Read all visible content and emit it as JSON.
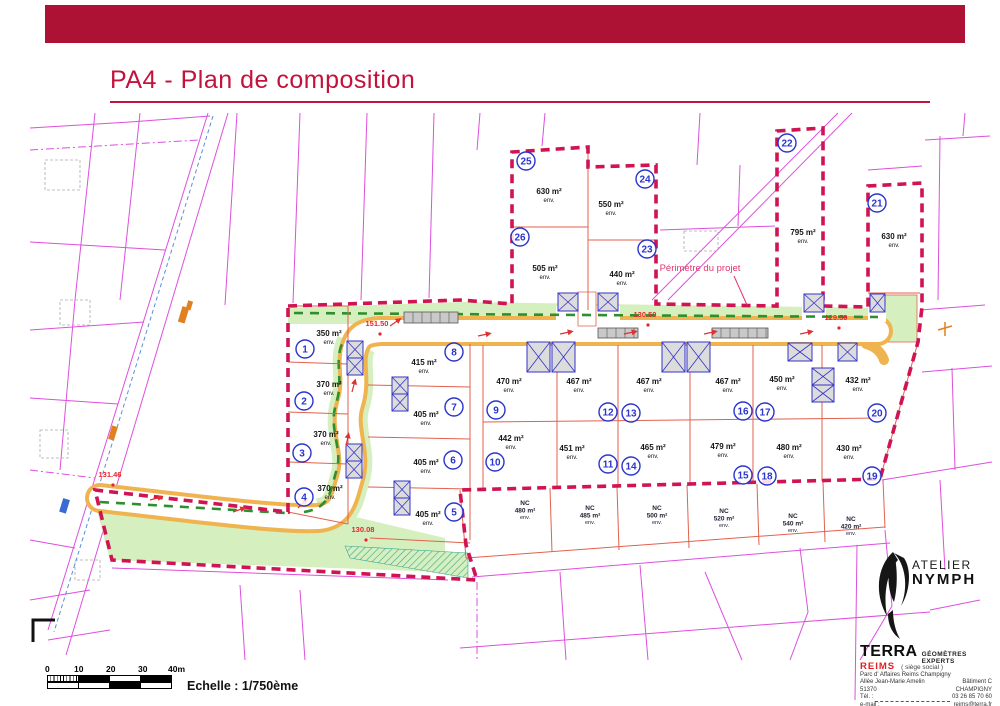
{
  "header": {
    "title": "PA4 - Plan de composition"
  },
  "colors": {
    "banner": "#ad1134",
    "title_red": "#c3123c",
    "perimeter_pink": "#d01353",
    "cadastral_magenta": "#dd4fdd",
    "lot_line_salmon": "#e2614e",
    "road_orange": "#efb44f",
    "green_strip": "#d6efbe",
    "hedge_green": "#2f8f2f",
    "building_blue": "#3535c8",
    "lot_number_blue": "#2a35cc",
    "elevation_red": "#e8242c"
  },
  "map": {
    "perimeter_label": "Périmètre du projet",
    "env_label": "env.",
    "lots": [
      {
        "n": "1",
        "area": "350 m²",
        "cx": 305,
        "cy": 349,
        "tx": 329,
        "ty": 336
      },
      {
        "n": "2",
        "area": "370 m²",
        "cx": 304,
        "cy": 401,
        "tx": 329,
        "ty": 387
      },
      {
        "n": "3",
        "area": "370 m²",
        "cx": 302,
        "cy": 453,
        "tx": 326,
        "ty": 437
      },
      {
        "n": "4",
        "area": "370 m²",
        "cx": 304,
        "cy": 497,
        "tx": 330,
        "ty": 491
      },
      {
        "n": "5",
        "area": "405 m²",
        "cx": 454,
        "cy": 512,
        "tx": 428,
        "ty": 517
      },
      {
        "n": "6",
        "area": "405 m²",
        "cx": 453,
        "cy": 460,
        "tx": 426,
        "ty": 465
      },
      {
        "n": "7",
        "area": "405 m²",
        "cx": 454,
        "cy": 407,
        "tx": 426,
        "ty": 417
      },
      {
        "n": "8",
        "area": "415 m²",
        "cx": 454,
        "cy": 352,
        "tx": 424,
        "ty": 365
      },
      {
        "n": "9",
        "area": "470 m²",
        "cx": 496,
        "cy": 410,
        "tx": 509,
        "ty": 384
      },
      {
        "n": "10",
        "area": "442 m²",
        "cx": 495,
        "cy": 462,
        "tx": 511,
        "ty": 441
      },
      {
        "n": "11",
        "area": "451 m²",
        "cx": 608,
        "cy": 464,
        "tx": 572,
        "ty": 451
      },
      {
        "n": "12",
        "area": "467 m²",
        "cx": 608,
        "cy": 412,
        "tx": 579,
        "ty": 384
      },
      {
        "n": "13",
        "area": "467 m²",
        "cx": 631,
        "cy": 413,
        "tx": 649,
        "ty": 384
      },
      {
        "n": "14",
        "area": "465 m²",
        "cx": 631,
        "cy": 466,
        "tx": 653,
        "ty": 450
      },
      {
        "n": "15",
        "area": "479 m²",
        "cx": 743,
        "cy": 475,
        "tx": 723,
        "ty": 449
      },
      {
        "n": "16",
        "area": "467 m²",
        "cx": 743,
        "cy": 411,
        "tx": 728,
        "ty": 384
      },
      {
        "n": "17",
        "area": "450 m²",
        "cx": 765,
        "cy": 412,
        "tx": 782,
        "ty": 382
      },
      {
        "n": "18",
        "area": "480 m²",
        "cx": 767,
        "cy": 476,
        "tx": 789,
        "ty": 450
      },
      {
        "n": "19",
        "area": "430 m²",
        "cx": 872,
        "cy": 476,
        "tx": 849,
        "ty": 451
      },
      {
        "n": "20",
        "area": "432 m²",
        "cx": 877,
        "cy": 413,
        "tx": 858,
        "ty": 383
      },
      {
        "n": "21",
        "area": "630 m²",
        "cx": 877,
        "cy": 203,
        "tx": 894,
        "ty": 239
      },
      {
        "n": "22",
        "area": "795 m²",
        "cx": 787,
        "cy": 143,
        "tx": 803,
        "ty": 235
      },
      {
        "n": "23",
        "area": "440 m²",
        "cx": 647,
        "cy": 249,
        "tx": 622,
        "ty": 277
      },
      {
        "n": "24",
        "area": "550 m²",
        "cx": 645,
        "cy": 179,
        "tx": 611,
        "ty": 207
      },
      {
        "n": "25",
        "area": "630 m²",
        "cx": 526,
        "cy": 161,
        "tx": 549,
        "ty": 194
      },
      {
        "n": "26",
        "area": "505 m²",
        "cx": 520,
        "cy": 237,
        "tx": 545,
        "ty": 271
      }
    ],
    "nc_lots": [
      {
        "label": "NC",
        "area": "480 m²",
        "x": 525,
        "y": 505
      },
      {
        "label": "NC",
        "area": "485 m²",
        "x": 590,
        "y": 510
      },
      {
        "label": "NC",
        "area": "500 m²",
        "x": 657,
        "y": 510
      },
      {
        "label": "NC",
        "area": "520 m²",
        "x": 724,
        "y": 513
      },
      {
        "label": "NC",
        "area": "540 m²",
        "x": 793,
        "y": 518
      },
      {
        "label": "NC",
        "area": "420 m²",
        "x": 851,
        "y": 521
      }
    ],
    "elevations": [
      {
        "v": "151.50",
        "x": 377,
        "y": 326
      },
      {
        "v": "130.08",
        "x": 363,
        "y": 532
      },
      {
        "v": "130.50",
        "x": 645,
        "y": 317
      },
      {
        "v": "129.50",
        "x": 836,
        "y": 320
      },
      {
        "v": "131.46",
        "x": 110,
        "y": 477
      }
    ],
    "buildings": [
      [
        347,
        341,
        16,
        17
      ],
      [
        347,
        358,
        16,
        17
      ],
      [
        346,
        444,
        16,
        17
      ],
      [
        346,
        461,
        16,
        17
      ],
      [
        392,
        377,
        16,
        17
      ],
      [
        392,
        394,
        16,
        17
      ],
      [
        394,
        481,
        16,
        17
      ],
      [
        394,
        498,
        16,
        17
      ],
      [
        527,
        342,
        23,
        30
      ],
      [
        552,
        342,
        23,
        30
      ],
      [
        662,
        342,
        23,
        30
      ],
      [
        687,
        342,
        23,
        30
      ],
      [
        788,
        343,
        24,
        18
      ],
      [
        838,
        343,
        19,
        18
      ],
      [
        812,
        368,
        22,
        17
      ],
      [
        812,
        385,
        22,
        17
      ],
      [
        558,
        293,
        20,
        18
      ],
      [
        598,
        293,
        20,
        18
      ],
      [
        804,
        294,
        20,
        18
      ],
      [
        870,
        294,
        15,
        18
      ]
    ],
    "parkings": [
      [
        404,
        312,
        54,
        11
      ],
      [
        598,
        328,
        40,
        10
      ],
      [
        712,
        328,
        56,
        10
      ]
    ],
    "arrows": [
      [
        390,
        326,
        -35
      ],
      [
        478,
        336,
        -12
      ],
      [
        560,
        334,
        -12
      ],
      [
        624,
        334,
        -12
      ],
      [
        704,
        334,
        -12
      ],
      [
        800,
        334,
        -12
      ],
      [
        352,
        392,
        -75
      ],
      [
        346,
        446,
        -78
      ],
      [
        298,
        508,
        -45
      ],
      [
        150,
        500,
        -15
      ],
      [
        233,
        512,
        -20
      ]
    ]
  },
  "scalebar": {
    "ticks": [
      "0",
      "10",
      "20",
      "30",
      "40m"
    ],
    "label": "Echelle : 1/750ème"
  },
  "branding": {
    "atelier": "ATELIER",
    "nymph": "NYMPH",
    "terra": "TERRA",
    "terra_sub": "GÉOMÈTRES EXPERTS",
    "reims": "REIMS",
    "siege": "( siège social )",
    "addr1": "Parc d' Affaires Reims Champigny",
    "addr2_l": "Allée Jean-Marie Amelin",
    "addr2_r": "Bâtiment C",
    "addr3_l": "51370",
    "addr3_r": "CHAMPIGNY",
    "tel_label": "Tél. :",
    "tel_value": "03 26 85 70 60",
    "email_label": "e-mail :",
    "email_value": "reims@terra.fr"
  }
}
